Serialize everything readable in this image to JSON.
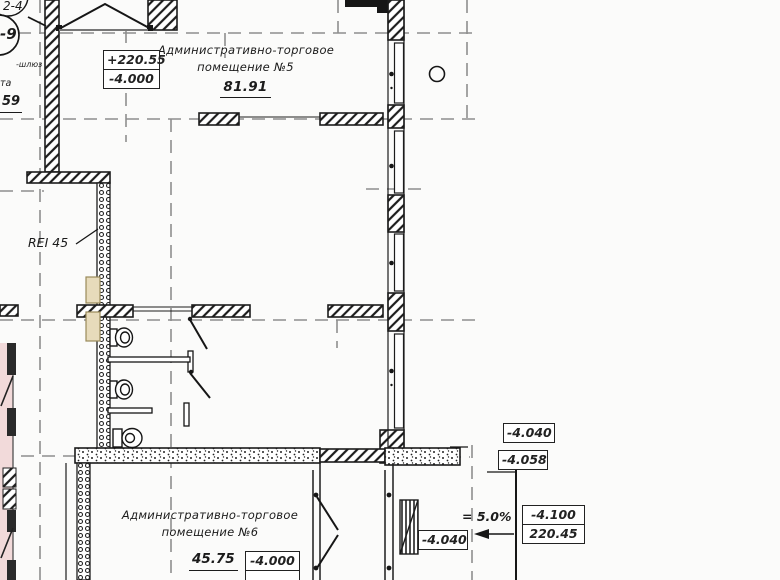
{
  "drawing": {
    "room5": {
      "title_line1": "Административно-торговое",
      "title_line2": "помещение №5",
      "area": "81.91"
    },
    "room6": {
      "title_line1": "Административно-торговое",
      "title_line2": "помещение №6",
      "area": "45.75"
    },
    "levels": {
      "room5_box_top": "+220.55",
      "room5_box_bottom": "-4.000",
      "right_top": "-4.040",
      "right_mid": "-4.058",
      "ramp_box_top": "-4.100",
      "ramp_box_bottom": "220.45",
      "left_of_ramp": "-4.040",
      "room6_box": "-4.000"
    },
    "annotations": {
      "fire_rating": "REI 45",
      "slope": "= 5.0%",
      "airlock": "-шлюз",
      "edge_word": "та",
      "edge_area": "59"
    },
    "grid_bubbles": {
      "bubble1": "2-4",
      "bubble2": "-9"
    },
    "colors": {
      "neighbor_zone": "#f2dada",
      "door_leaf_tan": "#e7dbbb",
      "axis_gray": "#8e8e8e",
      "line_black": "#1c1c1c"
    }
  }
}
